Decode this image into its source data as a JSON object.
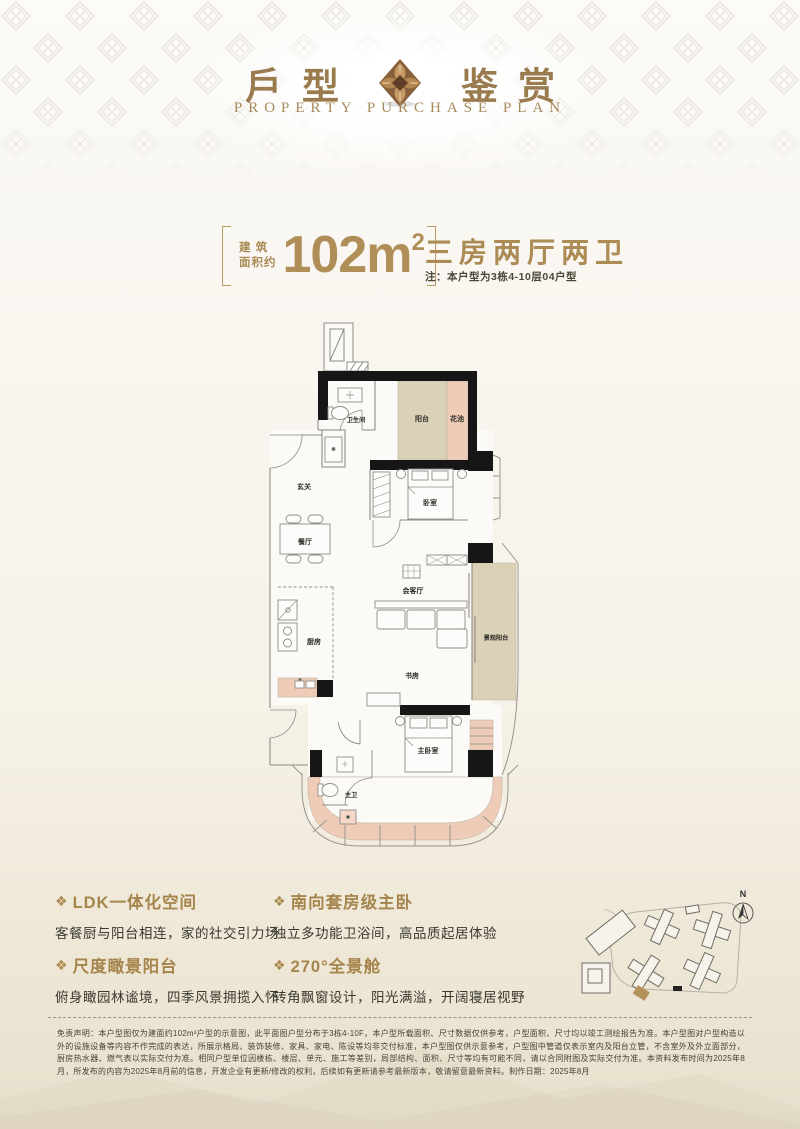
{
  "header": {
    "title_left": "戶型",
    "title_right": "鉴赏",
    "subtitle": "PROPERTY PURCHASE PLAN"
  },
  "spec": {
    "area_prefix_line1": "建 筑",
    "area_prefix_line2": "面积约",
    "area_value": "102m",
    "area_sup": "2",
    "layout_title": "三房两厅两卫",
    "note": "注：本户型为3栋4-10层04户型"
  },
  "plan": {
    "rooms": {
      "bathroom": "卫生间",
      "balcony": "阳台",
      "flower_bed": "花池",
      "foyer": "玄关",
      "bedroom": "卧室",
      "dining": "餐厅",
      "living": "会客厅",
      "kitchen": "厨房",
      "study": "书房",
      "view_balcony": "景观阳台",
      "master_bedroom": "主卧室",
      "master_bath": "主卫"
    }
  },
  "features": [
    {
      "icon": "❖",
      "title": "LDK一体化空间",
      "desc": "客餐厨与阳台相连，家的社交引力场"
    },
    {
      "icon": "❖",
      "title": "南向套房级主卧",
      "desc": "独立多功能卫浴间，高品质起居体验"
    },
    {
      "icon": "❖",
      "title": "尺度瞰景阳台",
      "desc": "俯身瞰园林谧境，四季风景拥揽入怀"
    },
    {
      "icon": "❖",
      "title": "270°全景舱",
      "desc": "转角飘窗设计，阳光满溢，开阔寝居视野"
    }
  ],
  "site_plan": {
    "north": "N"
  },
  "footer": {
    "disclaimer": "免责声明：本户型图仅为建面约102m²户型的示意图，此平面图户型分布于3栋4-10F，本户型所载面积、尺寸数据仅供参考，户型面积、尺寸均以竣工测绘报告为准。本户型图对户型构造以外的设施设备等内容不作完成的表达，所展示格局、装饰装修、家具、家电、陈设等均非交付标准，本户型图仅供示意参考，户型图中管道仅表示室内及阳台立管，不含室外及外立面部分，厨房热水器、燃气表以实际交付为准。相同户型单位因楼栋、楼层、单元、施工等差别，局部结构、面积、尺寸等均有可能不同，请以合同附图及实际交付为准。本资料发布时间为2025年8月，所发布的内容为2025年8月前的信息，开发企业有更新/修改的权利，后续如有更新请参考最新版本，敬请留意最新资料。制作日期：2025年8月"
  },
  "colors": {
    "accent_gold": "#a5854c",
    "number_gold": "#b08e58",
    "plan_tan": "#dbd1b6",
    "plan_pink": "#eeccb7",
    "wall_black": "#161616"
  }
}
